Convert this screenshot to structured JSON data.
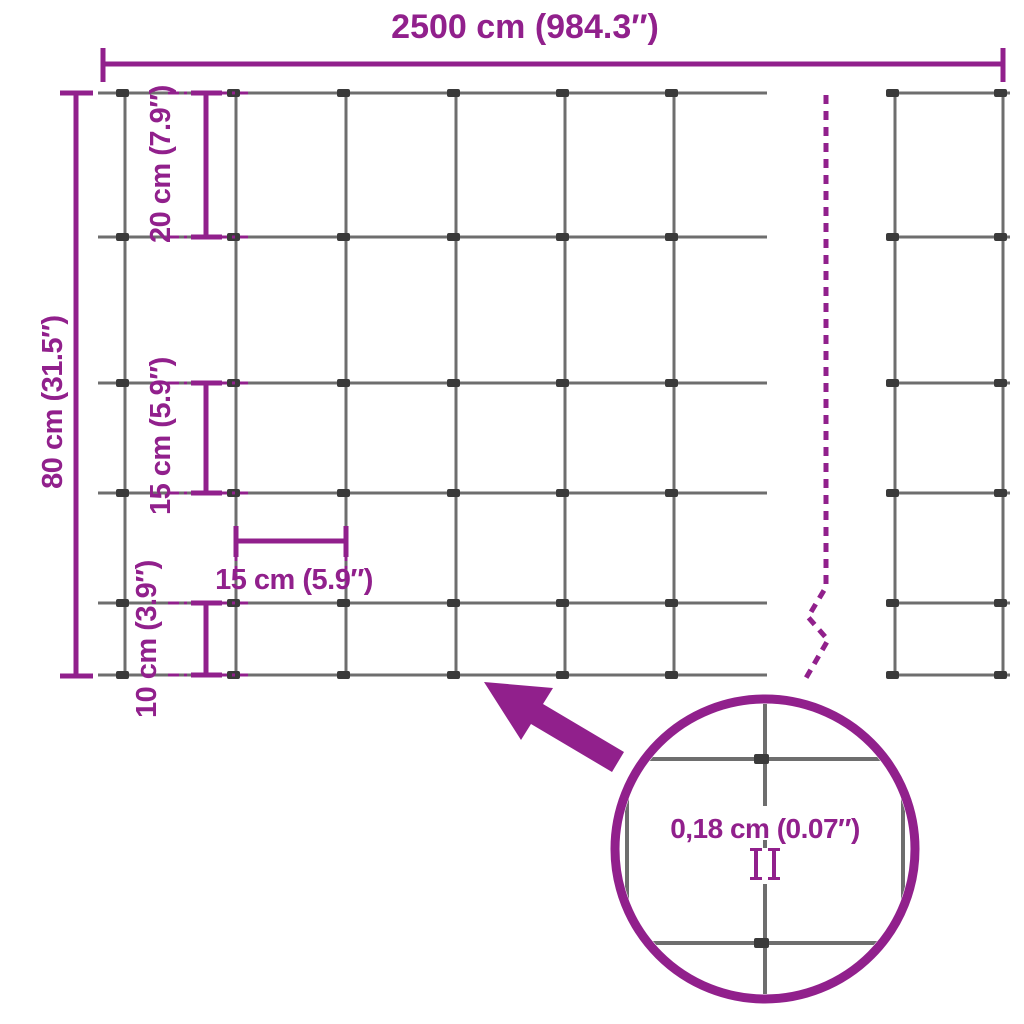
{
  "colors": {
    "accent": "#91208C",
    "wire": "#6E6E6E",
    "clip": "#3A3A3A",
    "background": "#FFFFFF"
  },
  "labels": {
    "total_width": "2500 cm (984.3″)",
    "total_height": "80 cm (31.5″)",
    "gap_top": "20 cm (7.9″)",
    "gap_middle": "15 cm (5.9″)",
    "gap_bottom": "10 cm (3.9″)",
    "cell_width": "15 cm (5.9″)",
    "wire_thickness": "0,18 cm (0.07″)"
  }
}
